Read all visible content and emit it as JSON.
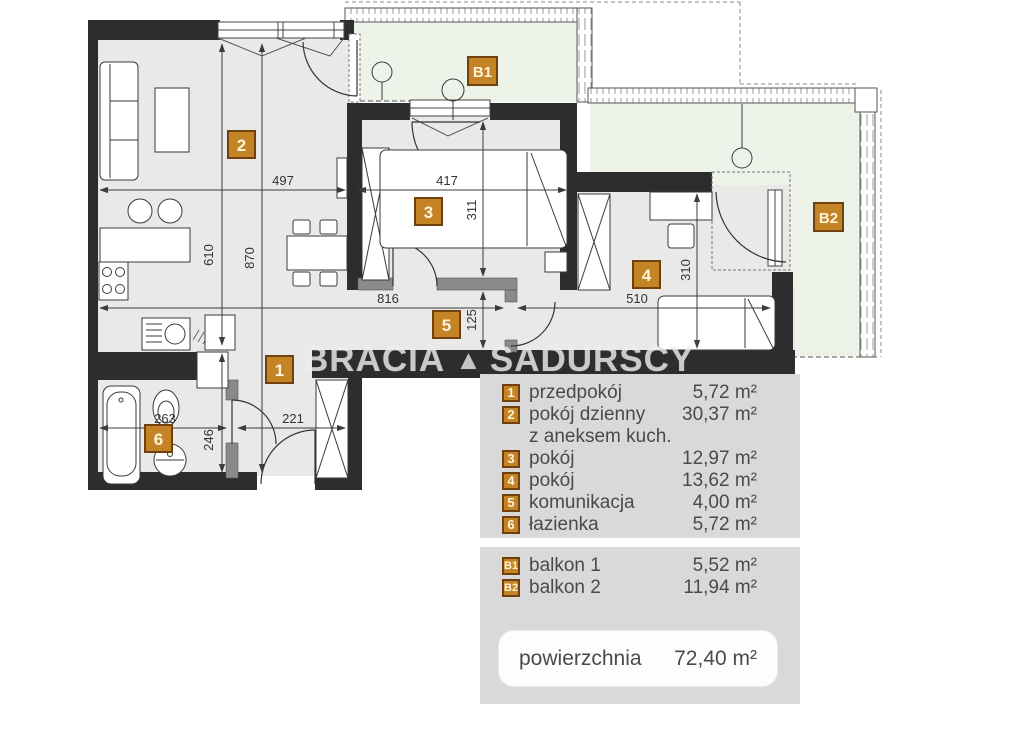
{
  "plan": {
    "watermark": {
      "word1": "BRACIA",
      "word2": "SADURSCY"
    },
    "badges": {
      "r1": "1",
      "r2": "2",
      "r3": "3",
      "r4": "4",
      "r5": "5",
      "r6": "6",
      "b1": "B1",
      "b2": "B2"
    },
    "dims": {
      "living_width": "497",
      "room3_width": "417",
      "room3_depth": "311",
      "living_depth": "610",
      "left_depth": "870",
      "corridor_width": "816",
      "corridor_depth": "125",
      "room4_width": "510",
      "room4_depth": "310",
      "bath_width": "263",
      "hall_width": "221",
      "hall_depth": "246"
    }
  },
  "legend": {
    "rooms": [
      {
        "num": "1",
        "label": "przedpokój",
        "area": "5,72 m²"
      },
      {
        "num": "2",
        "label": "pokój dzienny",
        "area": "30,37 m²"
      },
      {
        "num": "",
        "label": "z aneksem kuch.",
        "area": ""
      },
      {
        "num": "3",
        "label": "pokój",
        "area": "12,97 m²"
      },
      {
        "num": "4",
        "label": "pokój",
        "area": "13,62 m²"
      },
      {
        "num": "5",
        "label": "komunikacja",
        "area": "4,00 m²"
      },
      {
        "num": "6",
        "label": "łazienka",
        "area": "5,72 m²"
      }
    ],
    "balconies": [
      {
        "num": "B1",
        "label": "balkon 1",
        "area": "5,52 m²"
      },
      {
        "num": "B2",
        "label": "balkon 2",
        "area": "11,94 m²"
      }
    ],
    "total": {
      "label": "powierzchnia",
      "value": "72,40 m²"
    }
  },
  "colors": {
    "badge": "#c48325",
    "badge_border": "#70410e",
    "wall": "#2d2d2d",
    "balcony": "#eef3e9",
    "panel": "#d9d9d9"
  }
}
